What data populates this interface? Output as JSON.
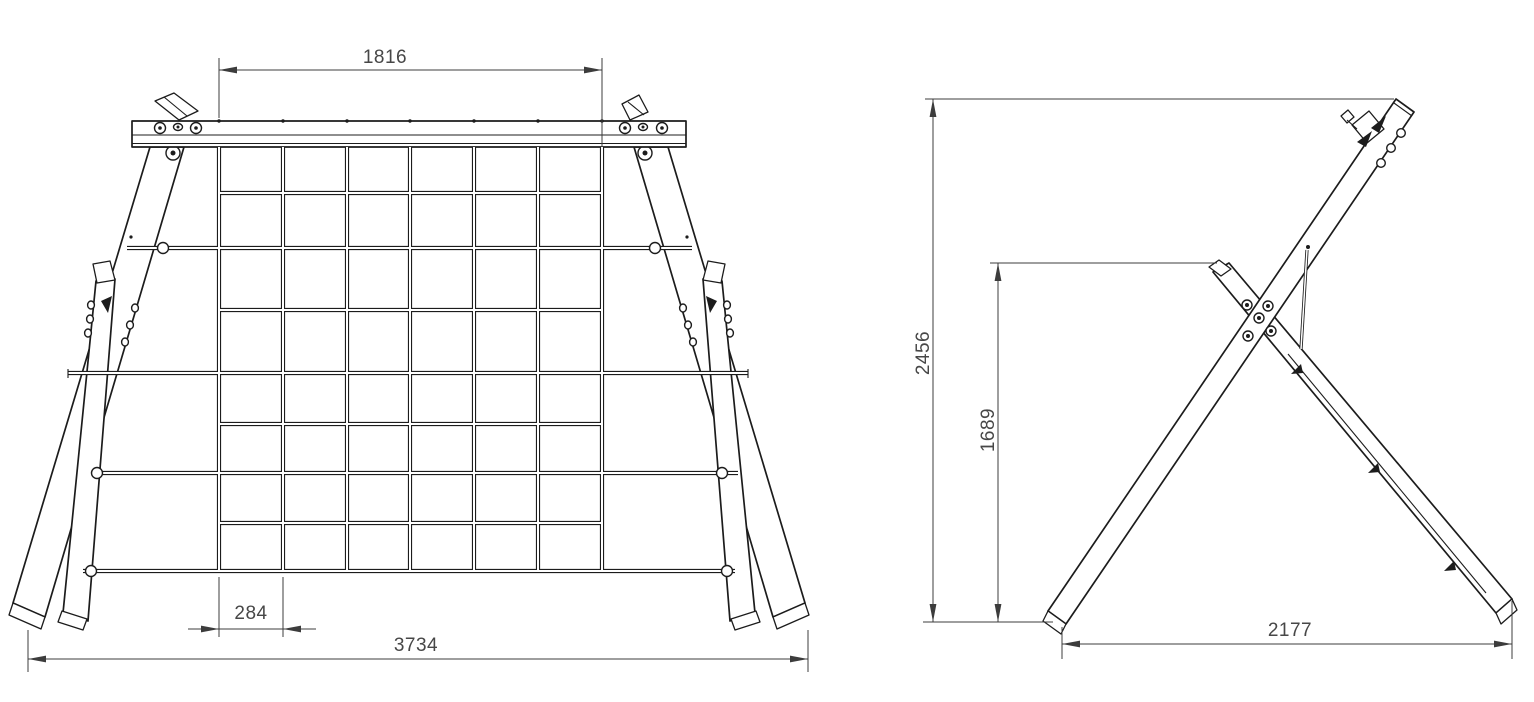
{
  "drawing": {
    "title": "climbing-net-a-frame-technical-drawing",
    "palette": {
      "background": "#ffffff",
      "line": "#1c1c1c",
      "dimension_line": "#3c3c3c",
      "dimension_text": "#474747"
    },
    "front_view": {
      "net_columns": 6,
      "net_rows": 8,
      "dims": {
        "net_width": "1816",
        "mesh_cell": "284",
        "overall_width": "3734"
      }
    },
    "side_view": {
      "dims": {
        "overall_height": "2456",
        "rear_leg_height": "1689",
        "base_depth": "2177"
      }
    }
  }
}
